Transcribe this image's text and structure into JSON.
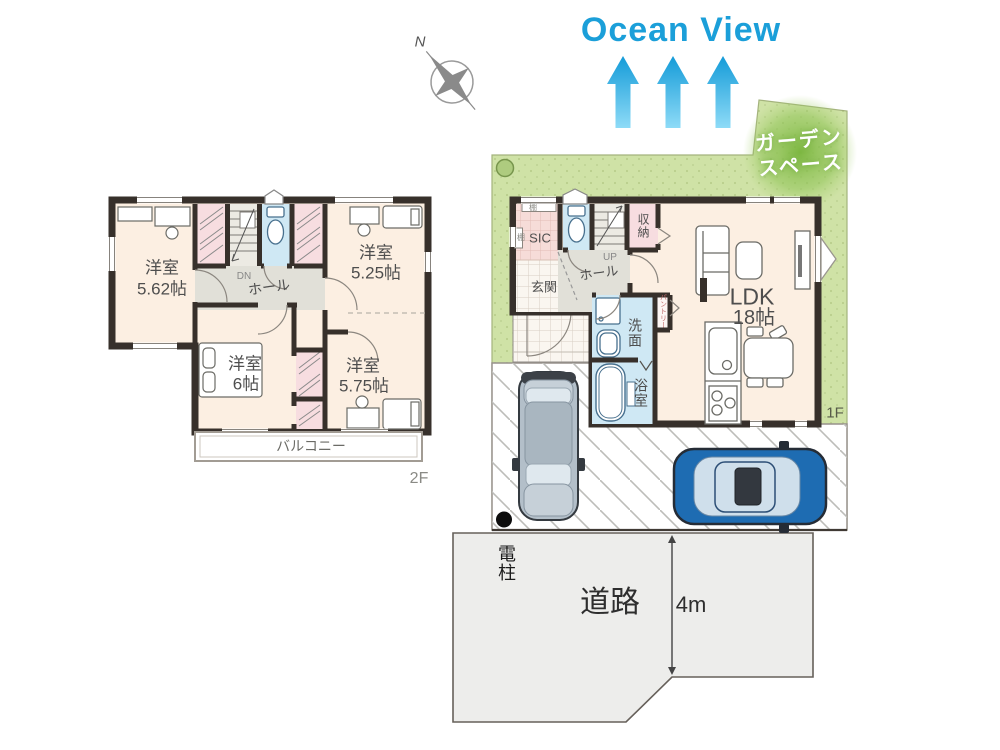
{
  "header": {
    "ocean_view": "Ocean View"
  },
  "compass": {
    "north": "N"
  },
  "floor2": {
    "label": "2F",
    "room_5_62": {
      "name": "洋室",
      "size": "5.62帖"
    },
    "room_5_25": {
      "name": "洋室",
      "size": "5.25帖"
    },
    "room_6": {
      "name": "洋室",
      "size": "6帖"
    },
    "room_5_75": {
      "name": "洋室",
      "size": "5.75帖"
    },
    "hall": "ホール",
    "stairs": "DN",
    "balcony": "バルコニー"
  },
  "floor1": {
    "label": "1F",
    "sic": "SIC",
    "shelf": "棚",
    "entrance": "玄関",
    "hall": "ホール",
    "stairs": "UP",
    "storage": "収納",
    "ldk_name": "LDK",
    "ldk_size": "18帖",
    "washroom": "洗面",
    "bathroom": "浴室",
    "pantry": "パントリー",
    "garden_line1": "ガーデン",
    "garden_line2": "スペース"
  },
  "site": {
    "utility_pole": "電柱",
    "road": "道路",
    "road_width": "4m"
  },
  "colors": {
    "ocean_blue": "#1b9fd9",
    "garden_green": "#cfe2a6",
    "garden_accent": "#7ab63e",
    "wall_dark": "#37302b",
    "room_cream": "#fcefe2",
    "closet_pink": "#f7dde0",
    "wet_area_blue": "#cfe8f4",
    "hall_gray": "#e1e0d8",
    "road_gray": "#ededeb",
    "car_blue": "#1e6cb2",
    "car_gray": "#b3bfc9"
  }
}
